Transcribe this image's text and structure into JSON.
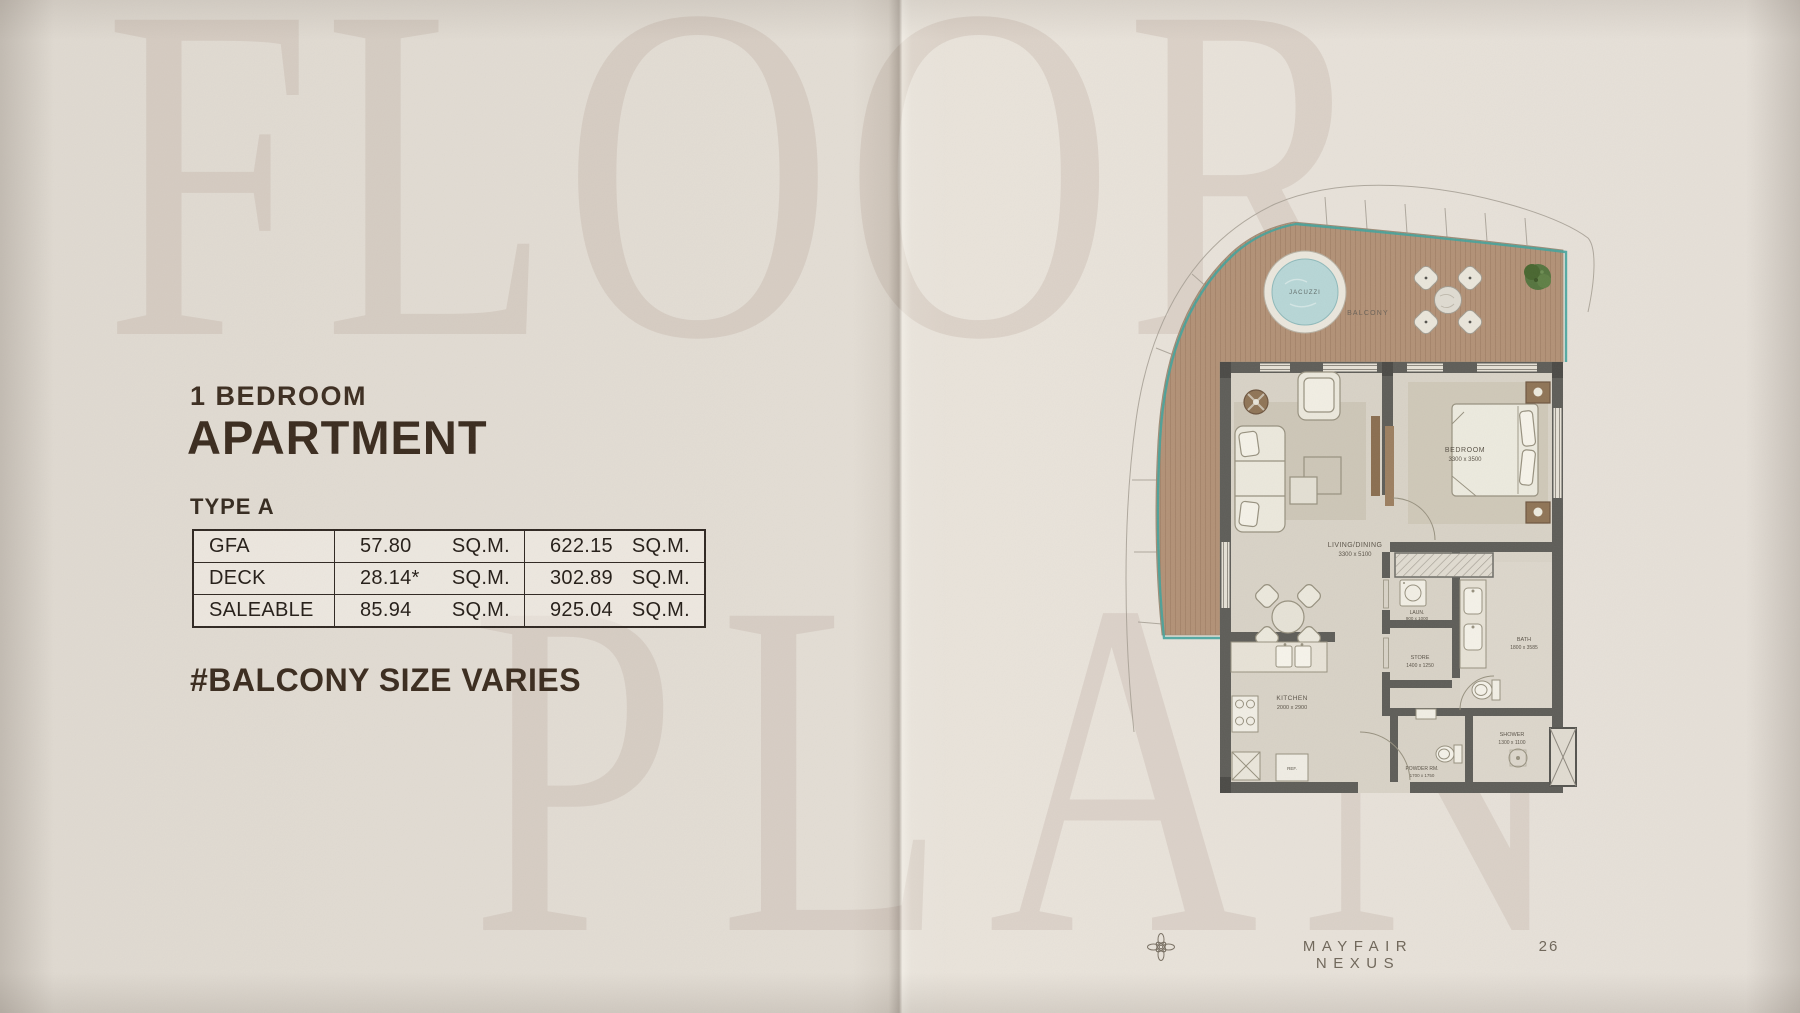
{
  "meta": {
    "brand": "MAYFAIR NEXUS",
    "page_number": "26"
  },
  "watermark": {
    "top": "FLOOR",
    "bottom": "PLAN"
  },
  "listing": {
    "subtitle": "1 BEDROOM",
    "title": "APARTMENT",
    "type_label": "TYPE A",
    "note": "#BALCONY SIZE VARIES",
    "area_table": {
      "rows": [
        {
          "label": "GFA",
          "metric_value": "57.80",
          "metric_unit": "SQ.M.",
          "imperial_value": "622.15",
          "imperial_unit": "SQ.M."
        },
        {
          "label": "DECK",
          "metric_value": "28.14*",
          "metric_unit": "SQ.M.",
          "imperial_value": "302.89",
          "imperial_unit": "SQ.M."
        },
        {
          "label": "SALEABLE",
          "metric_value": "85.94",
          "metric_unit": "SQ.M.",
          "imperial_value": "925.04",
          "imperial_unit": "SQ.M."
        }
      ]
    }
  },
  "floor_plan": {
    "rooms": {
      "jacuzzi": {
        "label": "JACUZZI"
      },
      "balcony": {
        "label": "BALCONY"
      },
      "bedroom": {
        "label": "BEDROOM",
        "dimensions": "3300 x 3500"
      },
      "living_dining": {
        "label": "LIVING/DINING",
        "dimensions": "3300 x 5100"
      },
      "kitchen": {
        "label": "KITCHEN",
        "dimensions": "2000 x 2900"
      },
      "laundry": {
        "label": "LAUN.",
        "dimensions": "900 x 1000"
      },
      "store": {
        "label": "STORE",
        "dimensions": "1400 x 1250"
      },
      "bath": {
        "label": "BATH",
        "dimensions": "1800 x 3585"
      },
      "powder_room": {
        "label": "POWDER RM.",
        "dimensions": "1700 x 1750"
      },
      "shower": {
        "label": "SHOWER",
        "dimensions": "1300 x 1100"
      },
      "fridge": {
        "label": "REF."
      }
    }
  },
  "colors": {
    "heading_brown": "#3a2b1e",
    "footer_gray": "#6f6659",
    "deck_wood": "#b29176",
    "glass_teal": "#45a39c",
    "wall_gray": "#5e5d58",
    "jacuzzi_water": "#b7d6d6",
    "plant_green": "#55743e",
    "paper": "#e3ddd4"
  }
}
